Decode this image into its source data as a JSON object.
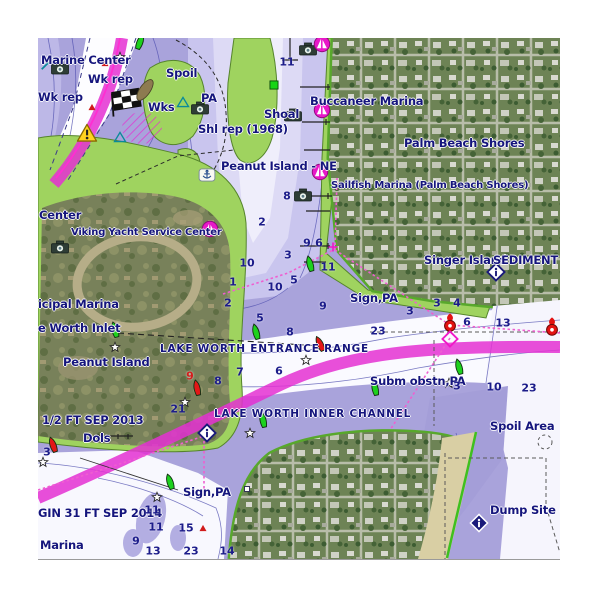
{
  "chart": {
    "region": "Lake Worth Inlet / Palm Beach Shores",
    "colors": {
      "water_base": "#a9a3db",
      "water_light": "#c9c5ee",
      "water_pale": "#dddaf5",
      "channel_white": "#fdfdff",
      "land_green": "#9fd35f",
      "shore_green": "#58a82c",
      "icw_magenta": "#e430d2",
      "route_magenta": "#ef5fd0",
      "label_navy": "#15157d",
      "depth_navy": "#1c1c8a",
      "hazard_red": "#d31d1d",
      "sand": "#d9cfa4"
    },
    "labels": [
      {
        "n": "label-marine-center",
        "t": "Marine Center",
        "x": 3,
        "y": 17,
        "c": ""
      },
      {
        "n": "label-wk-rep-1",
        "t": "Wk rep",
        "x": 50,
        "y": 36,
        "c": ""
      },
      {
        "n": "label-wk-rep-2",
        "t": "Wk rep",
        "x": 0,
        "y": 54,
        "c": ""
      },
      {
        "n": "label-spoil",
        "t": "Spoil",
        "x": 128,
        "y": 30,
        "c": ""
      },
      {
        "n": "label-wks",
        "t": "Wks",
        "x": 110,
        "y": 64,
        "c": ""
      },
      {
        "n": "label-pa",
        "t": "PA",
        "x": 163,
        "y": 55,
        "c": ""
      },
      {
        "n": "label-shl-rep",
        "t": "Shl rep (1968)",
        "x": 160,
        "y": 86,
        "c": ""
      },
      {
        "n": "label-shoal",
        "t": "Shoal",
        "x": 226,
        "y": 71,
        "c": ""
      },
      {
        "n": "label-buccaneer-marina",
        "t": "Buccaneer Marina",
        "x": 272,
        "y": 58,
        "c": ""
      },
      {
        "n": "label-palm-beach-shores",
        "t": "Palm Beach Shores",
        "x": 366,
        "y": 100,
        "c": ""
      },
      {
        "n": "label-peanut-island-ne",
        "t": "Peanut Island - NE",
        "x": 183,
        "y": 123,
        "c": ""
      },
      {
        "n": "label-sailfish-marina",
        "t": "Sailfish Marina (Palm Beach Shores)",
        "x": 293,
        "y": 143,
        "c": "sm"
      },
      {
        "n": "label-center-truncated",
        "t": "Center",
        "x": 1,
        "y": 172,
        "c": ""
      },
      {
        "n": "label-viking-yacht",
        "t": "Viking Yacht Service Center",
        "x": 33,
        "y": 190,
        "c": "sm"
      },
      {
        "n": "label-singer-island",
        "t": "Singer Island",
        "x": 386,
        "y": 217,
        "c": ""
      },
      {
        "n": "label-sediment",
        "t": "SEDIMENT",
        "x": 455,
        "y": 217,
        "c": ""
      },
      {
        "n": "label-sign-pa-1",
        "t": "Sign,PA",
        "x": 312,
        "y": 255,
        "c": ""
      },
      {
        "n": "label-municipal-marina",
        "t": "icipal Marina",
        "x": 0,
        "y": 261,
        "c": ""
      },
      {
        "n": "label-worth-inlet",
        "t": "e Worth Inlet",
        "x": 0,
        "y": 285,
        "c": ""
      },
      {
        "n": "label-entrance-range",
        "t": "LAKE WORTH ENTRANCE RANGE",
        "x": 122,
        "y": 306,
        "c": "rng"
      },
      {
        "n": "label-peanut-island",
        "t": "Peanut Island",
        "x": 25,
        "y": 319,
        "c": ""
      },
      {
        "n": "label-subm-obstn",
        "t": "Subm obstn,PA",
        "x": 332,
        "y": 338,
        "c": ""
      },
      {
        "n": "label-sep-2013",
        "t": "1/2 FT SEP 2013",
        "x": 4,
        "y": 377,
        "c": ""
      },
      {
        "n": "label-dols",
        "t": "Dols",
        "x": 45,
        "y": 395,
        "c": ""
      },
      {
        "n": "label-inner-channel",
        "t": "LAKE WORTH INNER CHANNEL",
        "x": 176,
        "y": 371,
        "c": "rng"
      },
      {
        "n": "label-spoil-area",
        "t": "Spoil Area",
        "x": 452,
        "y": 383,
        "c": ""
      },
      {
        "n": "label-sep-2014",
        "t": "GIN 31 FT SEP 2014",
        "x": 0,
        "y": 470,
        "c": ""
      },
      {
        "n": "label-sign-pa-2",
        "t": "Sign,PA",
        "x": 145,
        "y": 449,
        "c": ""
      },
      {
        "n": "label-marina",
        "t": "Marina",
        "x": 2,
        "y": 502,
        "c": ""
      },
      {
        "n": "label-dump-site",
        "t": "Dump Site (di",
        "x": 452,
        "y": 467,
        "c": ""
      }
    ],
    "depths": [
      {
        "v": "11",
        "x": 249,
        "y": 24
      },
      {
        "v": "8",
        "x": 249,
        "y": 158
      },
      {
        "v": "2",
        "x": 224,
        "y": 184
      },
      {
        "v": "9",
        "x": 269,
        "y": 205
      },
      {
        "v": "6",
        "x": 281,
        "y": 205
      },
      {
        "v": "3",
        "x": 250,
        "y": 217
      },
      {
        "v": "10",
        "x": 209,
        "y": 225
      },
      {
        "v": "11",
        "x": 290,
        "y": 229
      },
      {
        "v": "1",
        "x": 195,
        "y": 244
      },
      {
        "v": "10",
        "x": 237,
        "y": 249
      },
      {
        "v": "5",
        "x": 256,
        "y": 242
      },
      {
        "v": "2",
        "x": 190,
        "y": 265
      },
      {
        "v": "9",
        "x": 285,
        "y": 268
      },
      {
        "v": "5",
        "x": 222,
        "y": 280
      },
      {
        "v": "8",
        "x": 252,
        "y": 294
      },
      {
        "v": "7",
        "x": 202,
        "y": 334
      },
      {
        "v": "6",
        "x": 241,
        "y": 333
      },
      {
        "v": "8",
        "x": 180,
        "y": 343
      },
      {
        "v": "9",
        "x": 152,
        "y": 338,
        "red": true
      },
      {
        "v": "21",
        "x": 140,
        "y": 371
      },
      {
        "v": "23",
        "x": 340,
        "y": 293
      },
      {
        "v": "3",
        "x": 372,
        "y": 273
      },
      {
        "v": "3",
        "x": 399,
        "y": 265
      },
      {
        "v": "4",
        "x": 419,
        "y": 265
      },
      {
        "v": "6",
        "x": 429,
        "y": 284
      },
      {
        "v": "13",
        "x": 465,
        "y": 285
      },
      {
        "v": "3",
        "x": 419,
        "y": 348
      },
      {
        "v": "10",
        "x": 456,
        "y": 349
      },
      {
        "v": "23",
        "x": 491,
        "y": 350
      },
      {
        "v": "3",
        "x": 9,
        "y": 414
      },
      {
        "v": "11",
        "x": 114,
        "y": 472
      },
      {
        "v": "11",
        "x": 118,
        "y": 489
      },
      {
        "v": "9",
        "x": 98,
        "y": 503
      },
      {
        "v": "13",
        "x": 115,
        "y": 513
      },
      {
        "v": "23",
        "x": 153,
        "y": 513
      },
      {
        "v": "14",
        "x": 189,
        "y": 513
      },
      {
        "v": "15",
        "x": 148,
        "y": 490
      }
    ],
    "icons": [
      {
        "n": "photo-camera-icon",
        "t": "camera",
        "x": 22,
        "y": 30
      },
      {
        "n": "photo-camera-icon",
        "t": "camera",
        "x": 162,
        "y": 70
      },
      {
        "n": "photo-camera-icon",
        "t": "camera",
        "x": 255,
        "y": 77
      },
      {
        "n": "photo-camera-icon",
        "t": "camera",
        "x": 270,
        "y": 11
      },
      {
        "n": "photo-camera-icon",
        "t": "camera",
        "x": 265,
        "y": 157
      },
      {
        "n": "photo-camera-icon",
        "t": "camera",
        "x": 22,
        "y": 209
      },
      {
        "n": "marina-icon",
        "t": "marina",
        "x": 284,
        "y": 6
      },
      {
        "n": "marina-icon-buccaneer",
        "t": "marina",
        "x": 284,
        "y": 72
      },
      {
        "n": "marina-icon-sailfish",
        "t": "marina",
        "x": 282,
        "y": 134
      },
      {
        "n": "marina-icon-viking",
        "t": "marina",
        "x": 172,
        "y": 191
      },
      {
        "n": "info-diamond-icon",
        "t": "infol",
        "x": 458,
        "y": 234
      },
      {
        "n": "info-diamond-icon",
        "t": "infol",
        "x": 169,
        "y": 395
      },
      {
        "n": "info-diamond-icon-dark",
        "t": "infod",
        "x": 441,
        "y": 485
      },
      {
        "n": "green-square-mark",
        "t": "gsq",
        "x": 236,
        "y": 47
      },
      {
        "n": "small-sign-square",
        "t": "wsq",
        "x": 209,
        "y": 451
      },
      {
        "n": "green-buoy-icon",
        "t": "buoy",
        "x": 102,
        "y": 4,
        "r": 20,
        "c": "#1dd11d"
      },
      {
        "n": "green-buoy-icon",
        "t": "buoy",
        "x": 272,
        "y": 226,
        "r": -15,
        "c": "#1dd11d"
      },
      {
        "n": "green-buoy-icon",
        "t": "buoy",
        "x": 218,
        "y": 294,
        "r": -15,
        "c": "#1dd11d"
      },
      {
        "n": "green-buoy-icon",
        "t": "buoy",
        "x": 77,
        "y": 292,
        "r": -15,
        "c": "#1dd11d"
      },
      {
        "n": "green-buoy-icon",
        "t": "buoy",
        "x": 337,
        "y": 350,
        "r": -12,
        "c": "#1dd11d"
      },
      {
        "n": "green-buoy-icon",
        "t": "buoy",
        "x": 225,
        "y": 382,
        "r": -12,
        "c": "#1dd11d"
      },
      {
        "n": "green-buoy-icon",
        "t": "buoy",
        "x": 132,
        "y": 444,
        "r": -18,
        "c": "#1dd11d"
      },
      {
        "n": "green-buoy-icon",
        "t": "buoy",
        "x": 421,
        "y": 329,
        "r": -15,
        "c": "#1dd11d"
      },
      {
        "n": "red-buoy-icon",
        "t": "buoy",
        "x": 159,
        "y": 350,
        "r": -12,
        "c": "#e31717"
      },
      {
        "n": "red-buoy-icon",
        "t": "buoy",
        "x": 15,
        "y": 407,
        "r": -20,
        "c": "#e31717"
      },
      {
        "n": "red-buoy-icon",
        "t": "buoy",
        "x": 282,
        "y": 306,
        "r": -25,
        "c": "#e31717"
      },
      {
        "n": "red-lighted-buoy-icon",
        "t": "light",
        "x": 412,
        "y": 285
      },
      {
        "n": "red-lighted-buoy-icon",
        "t": "light",
        "x": 514,
        "y": 289
      },
      {
        "n": "waypoint-star-icon",
        "t": "star",
        "x": 82,
        "y": 19
      },
      {
        "n": "waypoint-star-icon",
        "t": "star",
        "x": 77,
        "y": 309
      },
      {
        "n": "waypoint-star-icon",
        "t": "star",
        "x": 147,
        "y": 364
      },
      {
        "n": "waypoint-star-icon",
        "t": "star",
        "x": 268,
        "y": 322
      },
      {
        "n": "waypoint-star-icon",
        "t": "star",
        "x": 411,
        "y": 345
      },
      {
        "n": "waypoint-star-icon",
        "t": "star",
        "x": 212,
        "y": 395
      },
      {
        "n": "waypoint-star-icon",
        "t": "star",
        "x": 119,
        "y": 459
      },
      {
        "n": "waypoint-star-icon",
        "t": "star",
        "x": 5,
        "y": 424
      },
      {
        "n": "rock-hazard-triangle",
        "t": "tri",
        "x": 67,
        "y": 25
      },
      {
        "n": "rock-hazard-triangle",
        "t": "tri",
        "x": 54,
        "y": 69
      },
      {
        "n": "rock-hazard-triangle",
        "t": "tri",
        "x": 165,
        "y": 490
      },
      {
        "n": "warning-icon",
        "t": "warn",
        "x": 49,
        "y": 95
      },
      {
        "n": "wreck-flag-icon",
        "t": "flag",
        "x": 86,
        "y": 66
      },
      {
        "n": "wreck-hull-icon",
        "t": "blob",
        "x": 107,
        "y": 52,
        "r": -55
      },
      {
        "n": "restricted-area-hatch",
        "t": "hatch",
        "x": 104,
        "y": 90
      },
      {
        "n": "fish-haven-triangle",
        "t": "ttri",
        "x": 145,
        "y": 64
      },
      {
        "n": "fish-haven-triangle",
        "t": "ttri",
        "x": 82,
        "y": 99
      },
      {
        "n": "beacon-slash-icon",
        "t": "tslash",
        "x": 8,
        "y": 27
      },
      {
        "n": "anchorage-icon",
        "t": "anch",
        "x": 169,
        "y": 137
      },
      {
        "n": "hazard-diamond-outline",
        "t": "mdia",
        "x": 412,
        "y": 301
      },
      {
        "n": "route-plus-mark",
        "t": "mplus",
        "x": 295,
        "y": 209
      }
    ]
  }
}
